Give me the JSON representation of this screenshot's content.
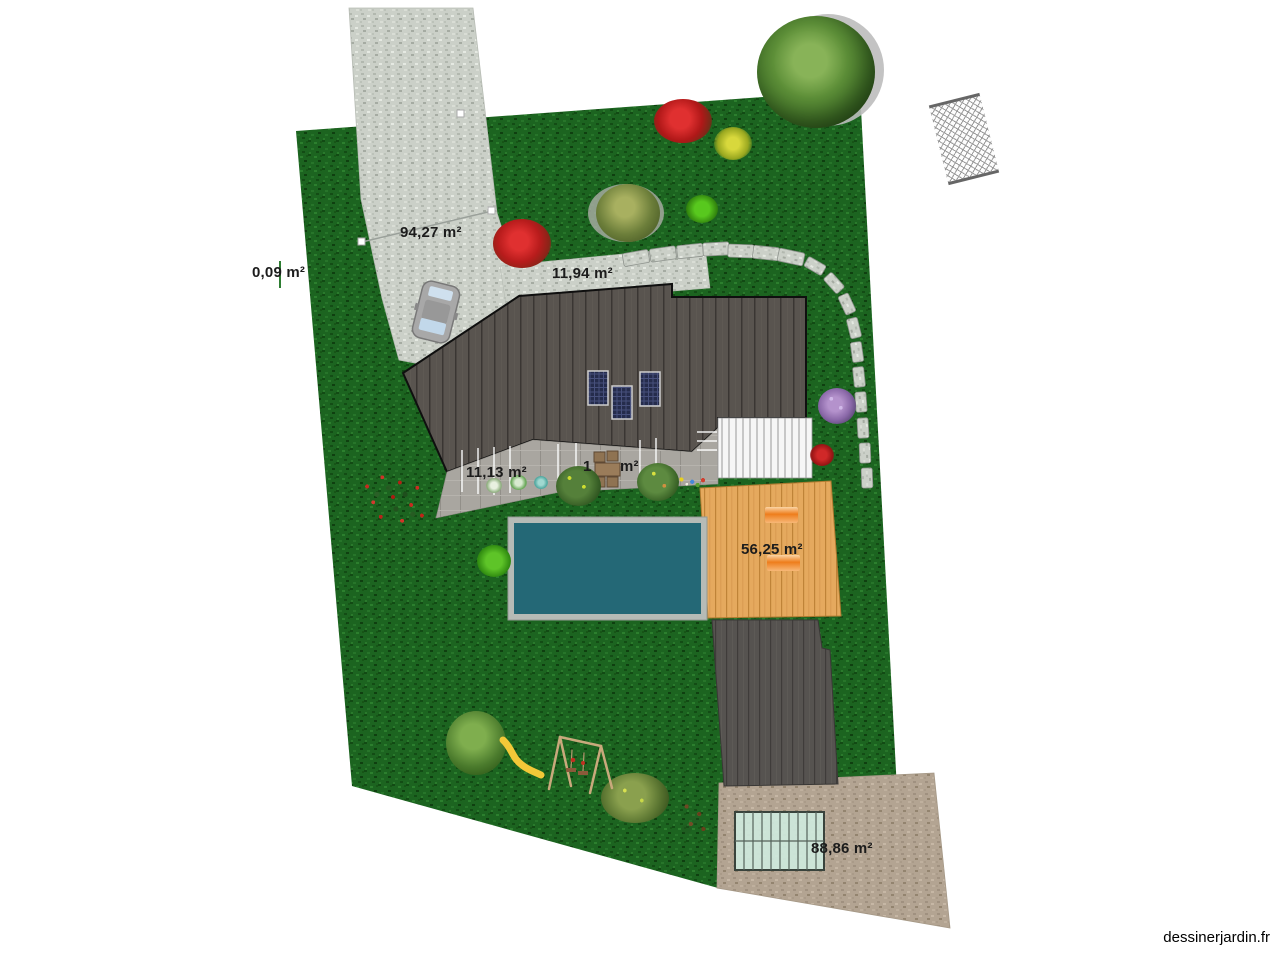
{
  "watermark": "dessinerjardin.fr",
  "area_labels": {
    "driveway": "94,27 m²",
    "left_boundary": "0,09 m²",
    "front_path": "11,94 m²",
    "side_terrace": "11,13 m²",
    "patio_prefix": "1",
    "patio_unit": "m²",
    "wood_deck": "56,25 m²",
    "rear_gravel": "88,86 m²"
  },
  "palette": {
    "lawn_green": "#1c6420",
    "gravel_light": "#cbd0c8",
    "gravel_tan": "#b3a492",
    "roof_gray": "#575350",
    "terrace_gray": "#a9a6a0",
    "deck_wood": "#e5a95e",
    "pool_water": "#246876",
    "pool_frame": "#b6bbb6",
    "greenhouse_glass": "#cee9dd",
    "solar_panel_blue": "#252c4c",
    "lounger_orange": "#ee7d1c",
    "dark_path": "#565350"
  },
  "icons": {
    "tree-icon": "gradient-circle",
    "bush-icon": "gradient-circle",
    "flower-bed-icon": "dotted-patch",
    "car-icon": "rounded-rect-top-view",
    "pool-icon": "framed-rect",
    "greenhouse-icon": "ribbed-glass-rect",
    "solar-panel-icon": "grid-rect",
    "lounger-icon": "orange-gradient-rect",
    "dining-set-icon": "table-and-four-chairs",
    "swing-set-icon": "a-frame-lines",
    "slide-icon": "yellow-curve",
    "stepping-stone-icon": "small-stone-rect",
    "hatch-swatch-icon": "crosshatch-rect"
  }
}
